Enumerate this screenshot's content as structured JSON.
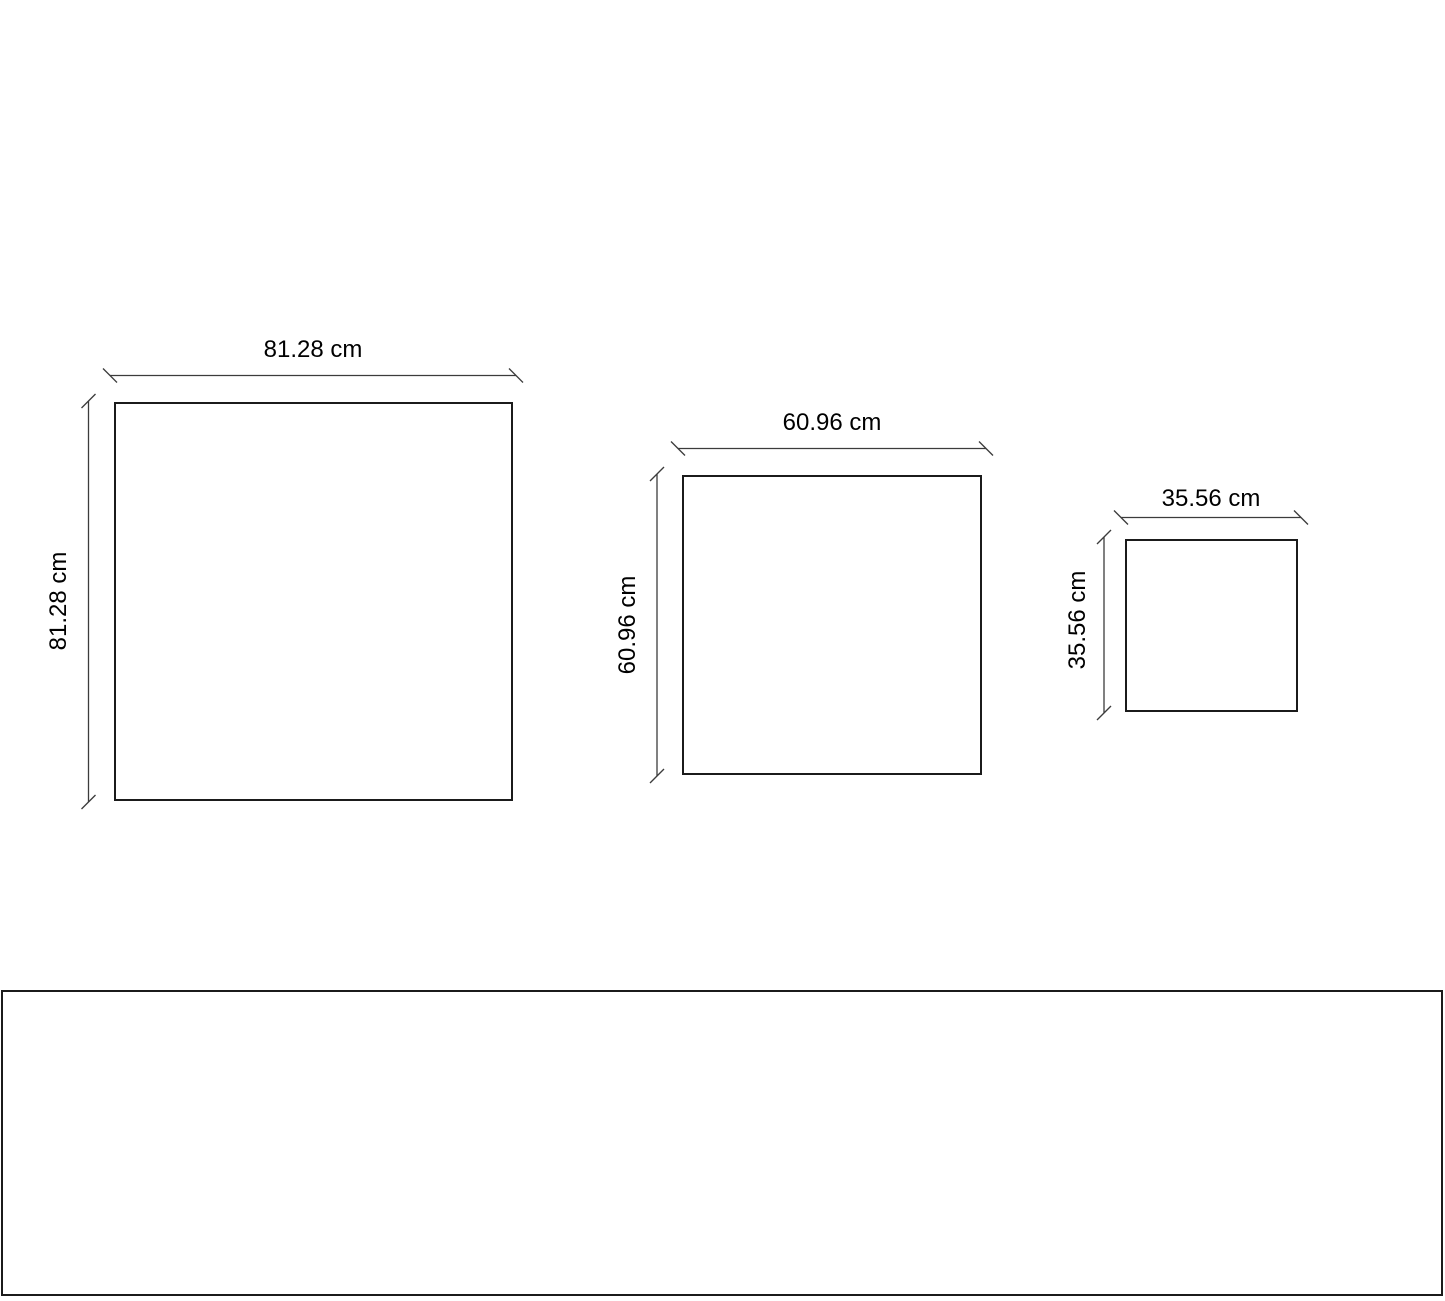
{
  "squares": [
    {
      "name": "large",
      "width_label": "81.28 cm",
      "height_label": "81.28 cm"
    },
    {
      "name": "medium",
      "width_label": "60.96 cm",
      "height_label": "60.96 cm"
    },
    {
      "name": "small",
      "width_label": "35.56 cm",
      "height_label": "35.56 cm"
    }
  ],
  "bottom_panel": {
    "label": ""
  },
  "colors": {
    "background": "#ffffff",
    "shape_border": "#1b1b1b",
    "dimension_line": "#3c3c3c",
    "text": "#000000"
  }
}
